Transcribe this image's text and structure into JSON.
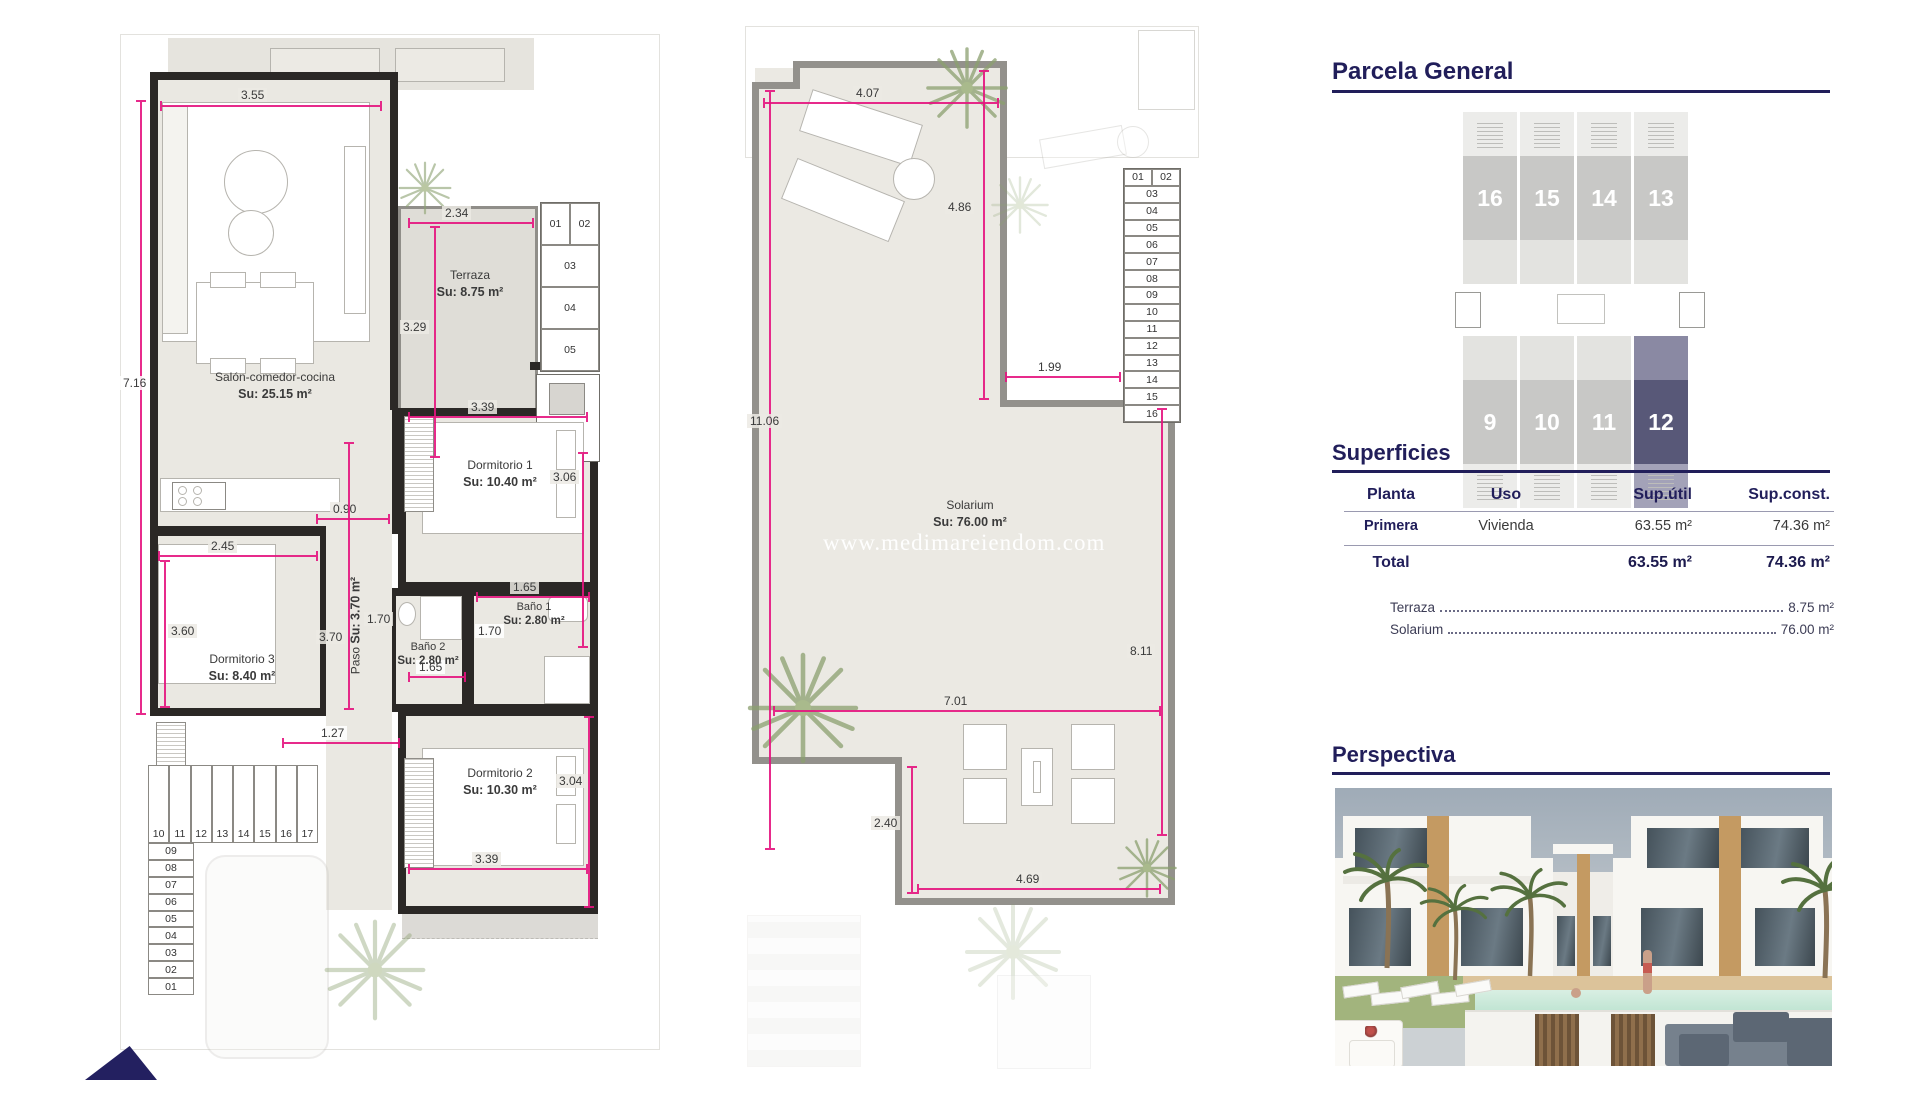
{
  "watermark": "www.medimareiendom.com",
  "plan1": {
    "rooms": {
      "salon": {
        "name": "Salón-comedor-cocina",
        "area": "Su: 25.15 m²"
      },
      "terraza": {
        "name": "Terraza",
        "area": "Su: 8.75 m²"
      },
      "dorm1": {
        "name": "Dormitorio 1",
        "area": "Su: 10.40 m²"
      },
      "dorm2": {
        "name": "Dormitorio 2",
        "area": "Su: 10.30 m²"
      },
      "dorm3": {
        "name": "Dormitorio 3",
        "area": "Su: 8.40 m²"
      },
      "paso": {
        "name": "Paso",
        "area": "Su: 3.70 m²"
      },
      "bano1": {
        "name": "Baño 1",
        "area": "Su: 2.80 m²"
      },
      "bano2": {
        "name": "Baño 2",
        "area": "Su: 2.80 m²"
      }
    },
    "dims": {
      "living_w": "3.55",
      "left_h": "7.16",
      "terraza_w": "2.34",
      "terraza_h": "3.29",
      "dorm1_w": "3.39",
      "dorm1_h": "3.06",
      "hall": "0.90",
      "dorm3_w": "2.45",
      "dorm3_h": "3.60",
      "paso_h": "3.70",
      "bano2_side": "1.70",
      "bano1_w": "1.65",
      "bano1_side": "1.70",
      "bano2_w": "1.65",
      "entrance": "1.27",
      "dorm2_w": "3.39",
      "dorm2_h": "3.04"
    },
    "stairs_upper": [
      "01",
      "02",
      "03",
      "04",
      "05"
    ],
    "stairs_lower_h": [
      "10",
      "11",
      "12",
      "13",
      "14",
      "15",
      "16",
      "17"
    ],
    "stairs_lower_v": [
      "09",
      "08",
      "07",
      "06",
      "05",
      "04",
      "03",
      "02",
      "01"
    ]
  },
  "plan2": {
    "room": {
      "name": "Solarium",
      "area": "Su: 76.00 m²"
    },
    "dims": {
      "top_w": "4.07",
      "upper_h": "4.86",
      "left_h": "11.06",
      "notch_w": "1.99",
      "right_h": "8.11",
      "mid_w": "7.01",
      "lower_h": "2.40",
      "bottom_w": "4.69"
    },
    "stairs": [
      "01",
      "02",
      "03",
      "04",
      "05",
      "06",
      "07",
      "08",
      "09",
      "10",
      "11",
      "12",
      "13",
      "14",
      "15",
      "16"
    ]
  },
  "panel": {
    "parcela_title": "Parcela General",
    "units_top": [
      "16",
      "15",
      "14",
      "13"
    ],
    "units_bottom": [
      "9",
      "10",
      "11",
      "12"
    ],
    "superficies_title": "Superficies",
    "table": {
      "headers": [
        "Planta",
        "Uso",
        "Sup.útil",
        "Sup.const."
      ],
      "row": {
        "planta": "Primera",
        "uso": "Vivienda",
        "util": "63.55 m²",
        "cons": "74.36 m²"
      },
      "total_label": "Total",
      "total_util": "63.55 m²",
      "total_cons": "74.36 m²",
      "extras": [
        {
          "label": "Terraza",
          "value": "8.75 m²"
        },
        {
          "label": "Solarium",
          "value": "76.00 m²"
        }
      ]
    },
    "perspectiva_title": "Perspectiva"
  },
  "colors": {
    "navy": "#211e5a",
    "dim_magenta": "#e5147f",
    "wall": "#2b2826",
    "unit_gray": "#c8c8c6",
    "unit_highlight": "#585878"
  }
}
